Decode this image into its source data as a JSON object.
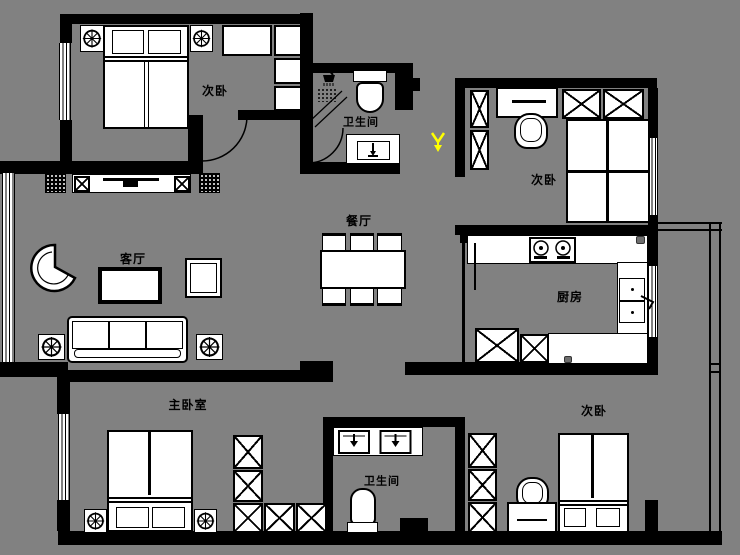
{
  "colors": {
    "background": "#818181",
    "wall": "#000000",
    "furniture_fill": "#ffffff",
    "entry_marker": "#ffff00"
  },
  "labels": {
    "bedroom_top_left": "次卧",
    "bathroom_top": "卫生间",
    "dining": "餐厅",
    "living": "客厅",
    "bedroom_top_right": "次卧",
    "kitchen": "厨房",
    "master_bedroom": "主卧室",
    "bathroom_bottom": "卫生间",
    "bedroom_bottom_right": "次卧"
  },
  "marker": {
    "name": "entry-arrow",
    "color": "#ffff00"
  }
}
